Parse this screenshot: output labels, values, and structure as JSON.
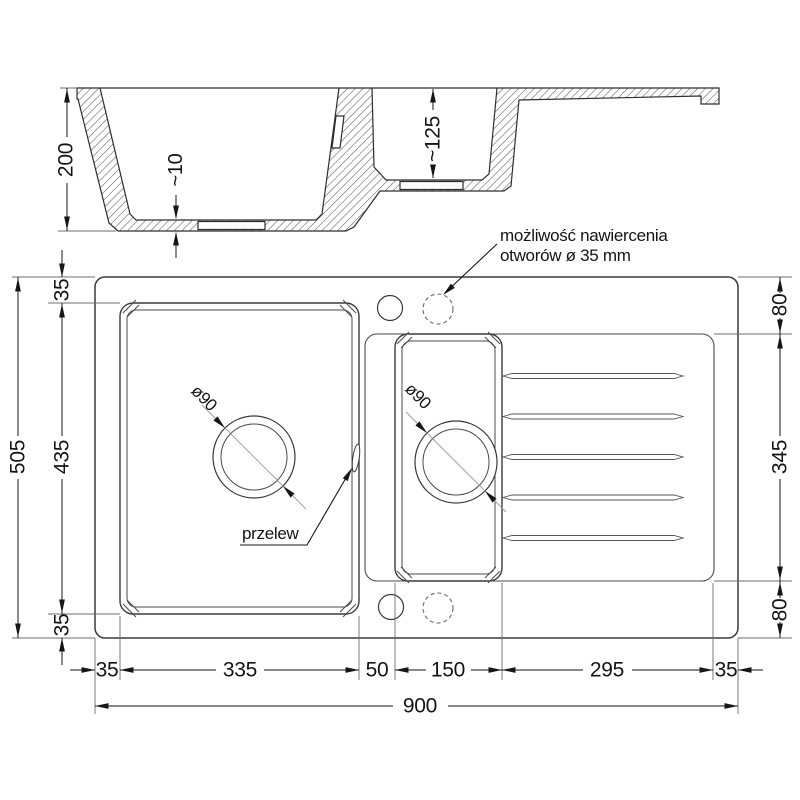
{
  "drawing": {
    "section": {
      "depth_overall": "200",
      "bottom_thickness": "~10",
      "depth_small_bowl": "~125"
    },
    "plan": {
      "drill_note_line1": "możliwość nawiercenia",
      "drill_note_line2": "otworów ø 35 mm",
      "overflow_label": "przelew",
      "drain_main": "ø90",
      "drain_small": "ø90",
      "bottom_dims": [
        "35",
        "335",
        "50",
        "150",
        "295",
        "35"
      ],
      "total_width": "900",
      "left_dims": [
        "35",
        "435",
        "35"
      ],
      "total_height": "505",
      "right_dims": [
        "80",
        "345",
        "80"
      ]
    },
    "colors": {
      "background": "#ffffff",
      "geometry_line": "#3a3a3a",
      "dimension_line": "#161616",
      "hatch": "#5a5a5a"
    }
  }
}
